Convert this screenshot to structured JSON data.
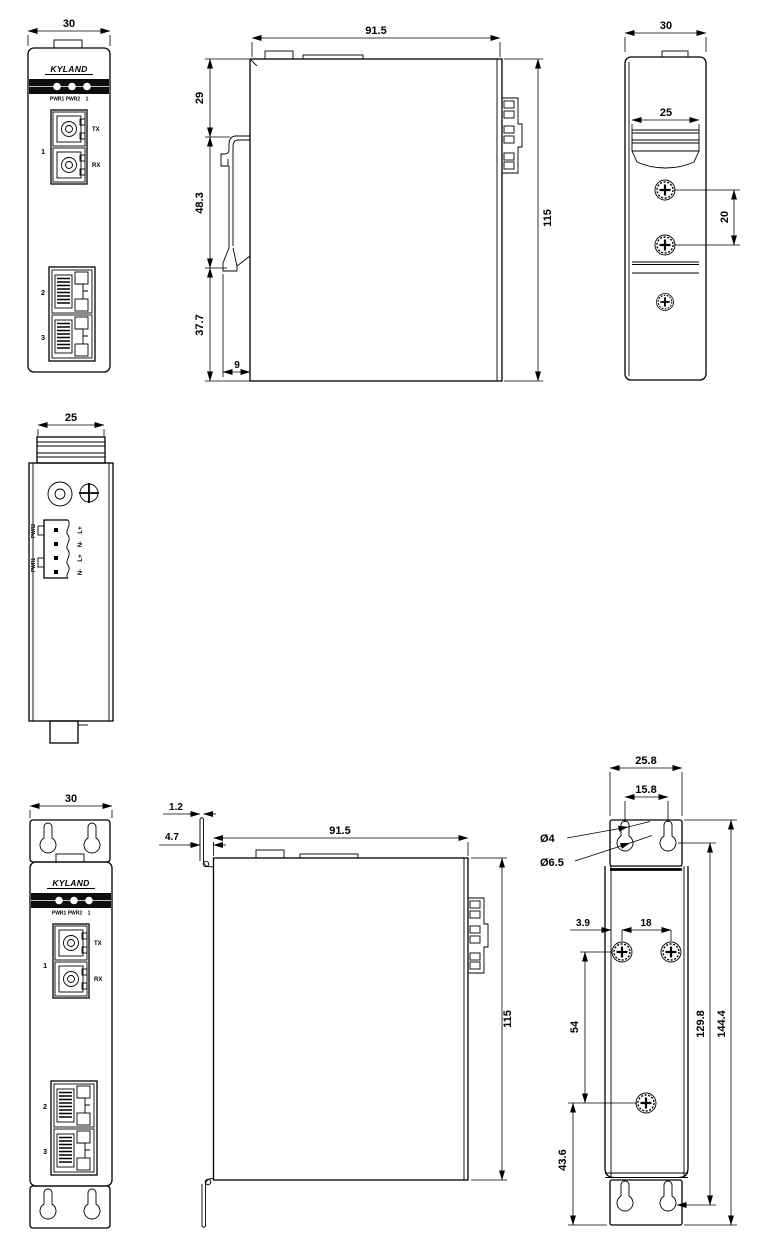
{
  "brand": "KYLAND",
  "front": {
    "width_mm": "30",
    "led_pwr": "PWR1 PWR2",
    "led_port": "1",
    "fiber_port": "1",
    "tx": "TX",
    "rx": "RX",
    "eth2": "2",
    "eth3": "3"
  },
  "side_din": {
    "width": "91.5",
    "height": "115",
    "seg_top": "29",
    "seg_mid": "48.3",
    "seg_bot": "37.7",
    "clip_depth": "9"
  },
  "rear_din": {
    "width": "30",
    "rail_width": "25",
    "screw_gap": "20"
  },
  "top_view": {
    "clip_width": "25",
    "pwr_top": "PWR2",
    "pwr_bot": "PWR1",
    "t1": "L+",
    "t2": "N-",
    "t3": "L+",
    "t4": "N-"
  },
  "front_wall": {
    "width": "30"
  },
  "side_wall": {
    "plate_thickness": "1.2",
    "plate_offset": "4.7",
    "width": "91.5",
    "height": "115"
  },
  "rear_wall": {
    "plate_width": "25.8",
    "keyhole_gap": "15.8",
    "dia_small": "Ø4",
    "dia_large": "Ø6.5",
    "screw_edge": "3.9",
    "screw_gap_h": "18",
    "screw_gap_v": "54",
    "keyhole_span": "129.8",
    "plate_height": "144.4",
    "bottom_offset": "43.6"
  }
}
